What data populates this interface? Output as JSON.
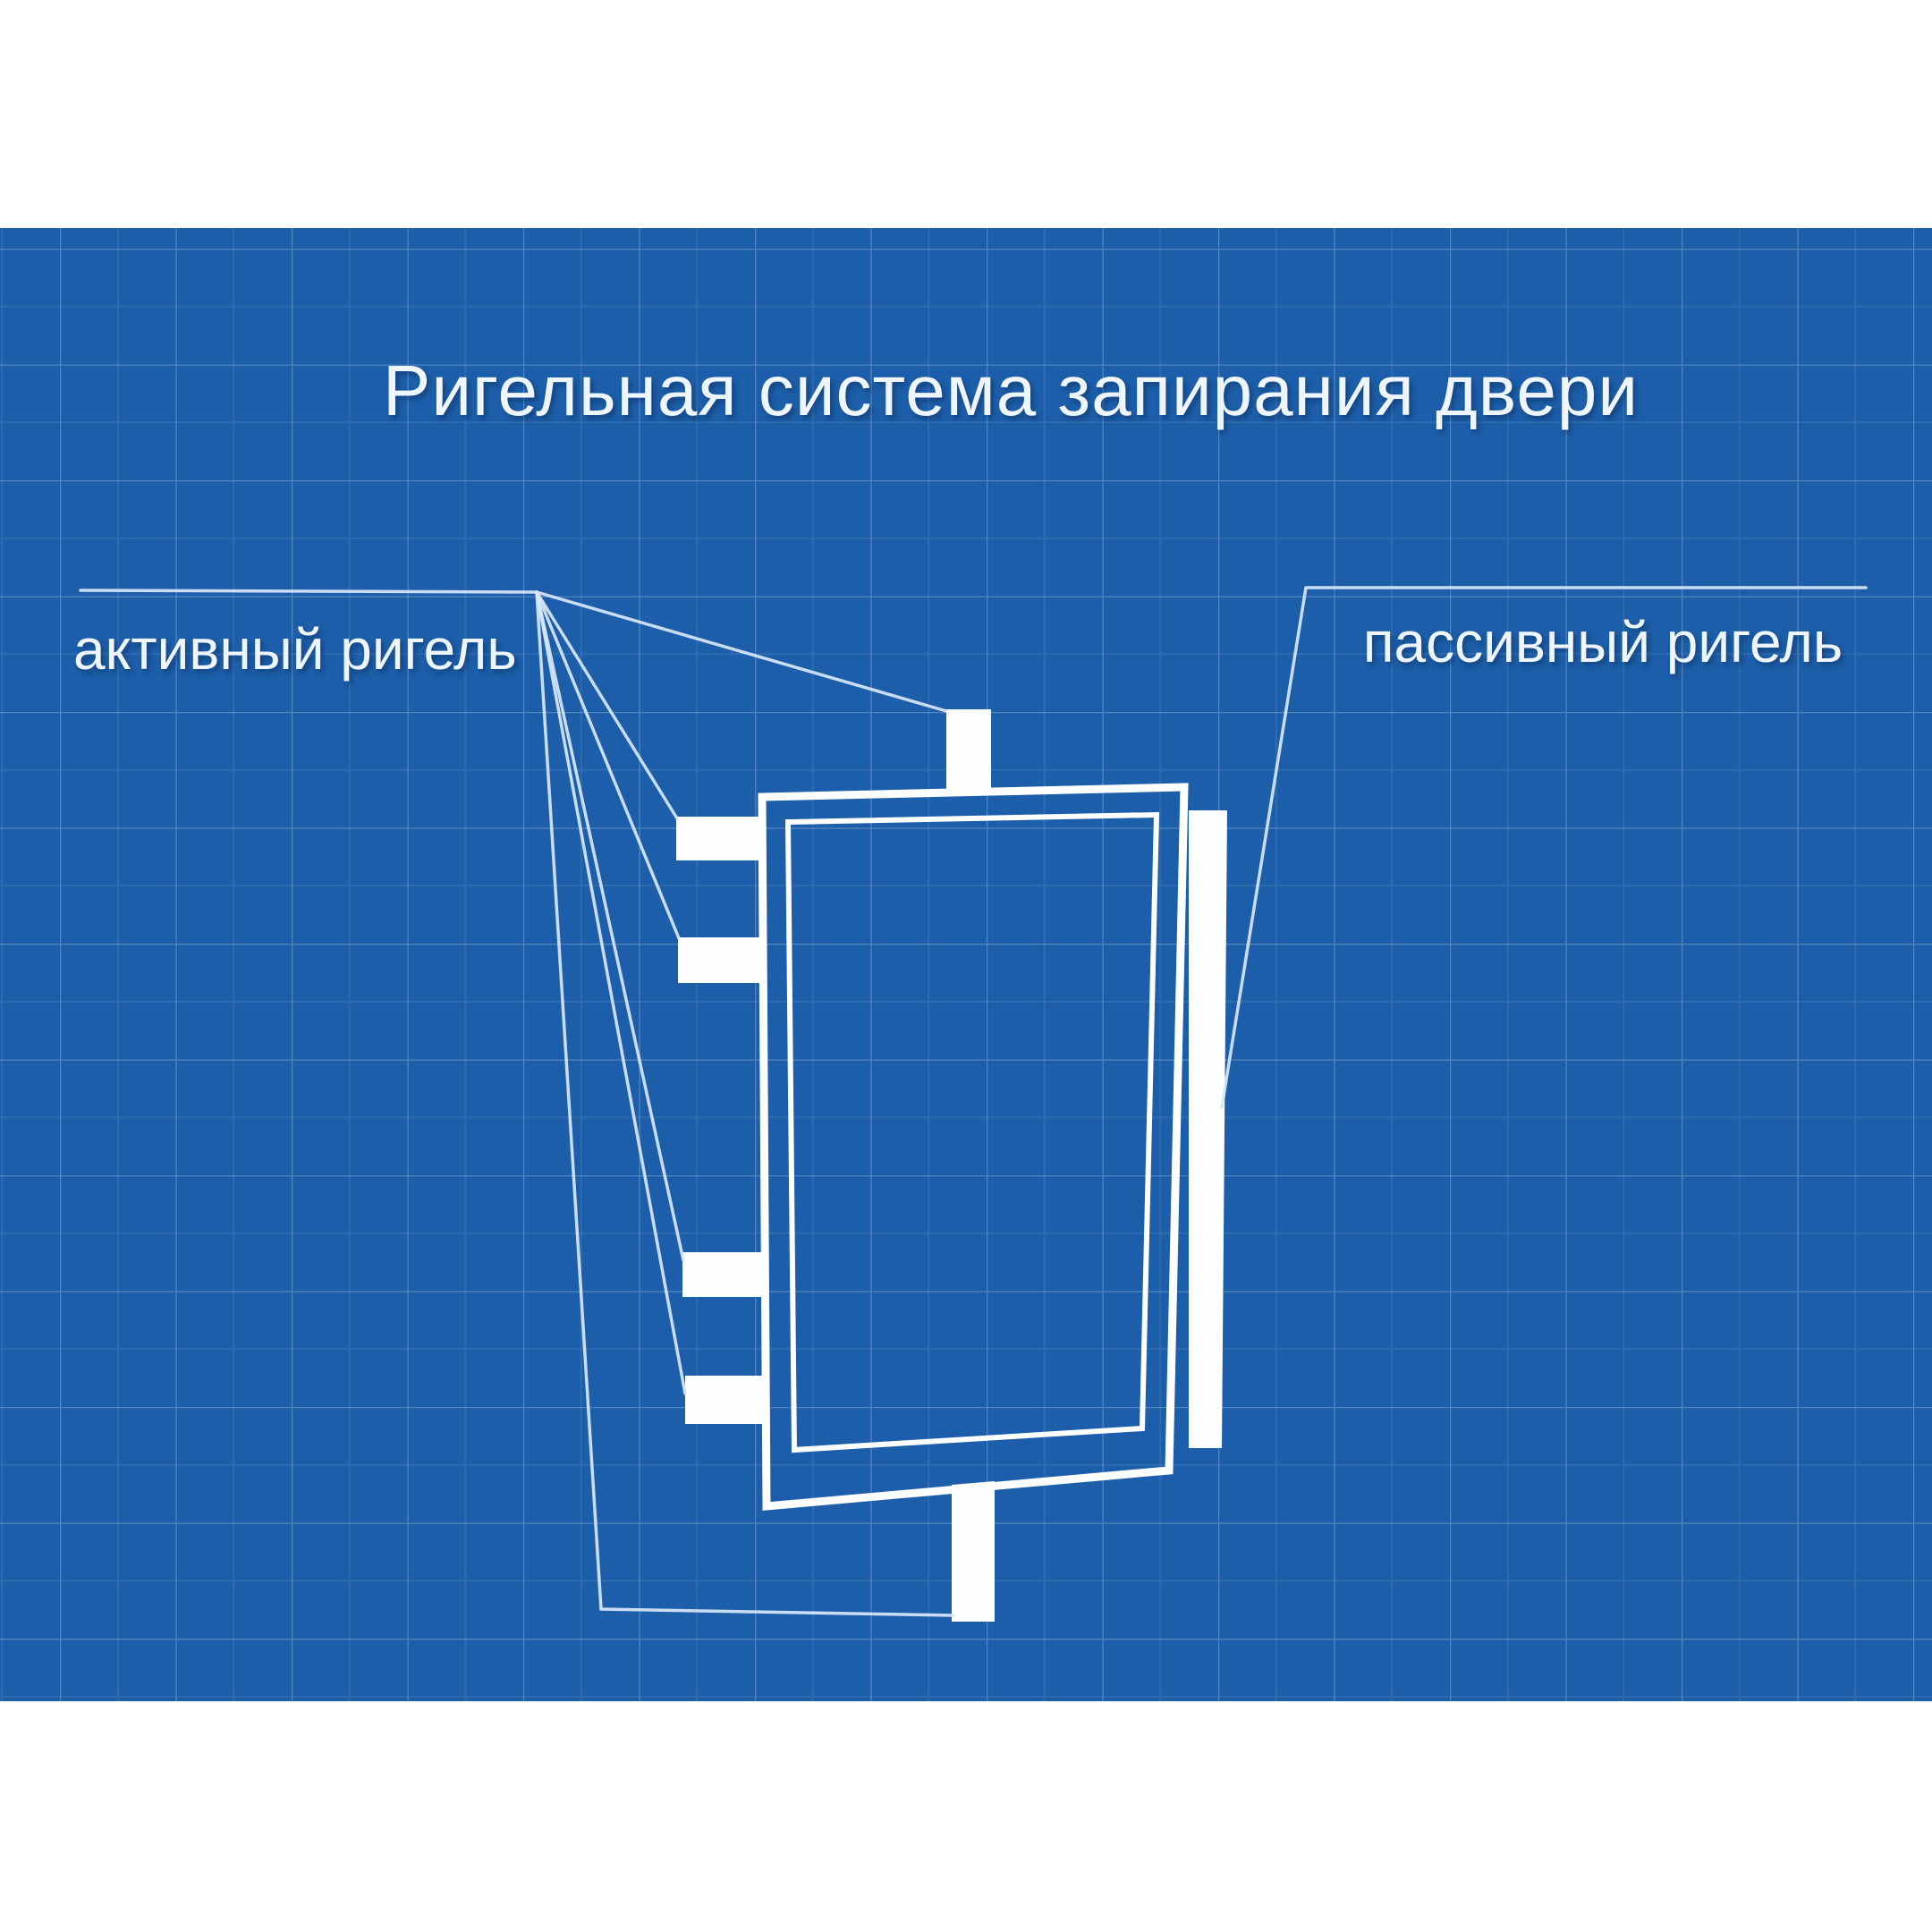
{
  "colors": {
    "canvas_bg": "#ffffff",
    "blueprint_bg": "#1c5ea9",
    "grid_line": "#ffffff",
    "shape_white": "#fdfeff",
    "line_light": "#d8e8f8",
    "text_color": "#eef5fd"
  },
  "title": {
    "text": "Ригельная система запирания двери"
  },
  "labels": {
    "active_bolt": "активный ригель",
    "passive_bolt": "пассивный ригель"
  }
}
